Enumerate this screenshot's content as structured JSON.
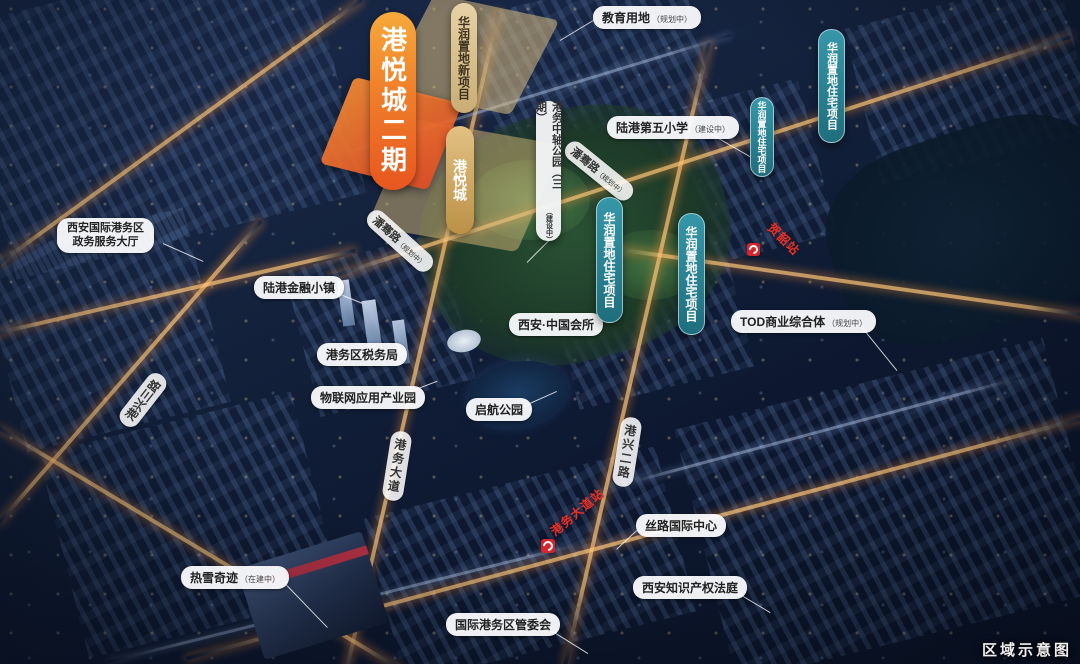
{
  "badges": {
    "main": "港悦城二期",
    "cr_new": "华润置地新项目",
    "gyc": "港悦城",
    "axis_park": {
      "text": "港务中轴公园（三期）",
      "status": "（建设中）"
    },
    "cr_res": "华润置地住宅项目"
  },
  "pois": {
    "education": {
      "text": "教育用地",
      "status": "（规划中）"
    },
    "school": {
      "text": "陆港第五小学",
      "status": "（建设中）"
    },
    "gov": {
      "line1": "西安国际港务区",
      "line2": "政务服务大厅"
    },
    "finance_town": "陆港金融小镇",
    "tax_bureau": "港务区税务局",
    "iot_park": "物联网应用产业园",
    "qihang_park": "启航公园",
    "china_club": "西安·中国会所",
    "tod": {
      "text": "TOD商业综合体",
      "status": "（规划中）"
    },
    "silk_center": "丝路国际中心",
    "ip_court": "西安知识产权法庭",
    "admin_committee": "国际港务区管委会",
    "snow_world": {
      "text": "热雪奇迹",
      "status": "（在建中）"
    }
  },
  "roads": {
    "gangxing3": "港兴三路",
    "gangwu_ave": "港务大道",
    "gangxing2": "港兴二路",
    "panqian": {
      "text": "潘骞路",
      "status": "（规划中）"
    }
  },
  "metro": {
    "heshao": "贺韶站",
    "gangwu_station": "港务大道站"
  },
  "footer": "区域示意图",
  "colors": {
    "main_badge_orange": "#e8561f",
    "cr_teal": "#2f8d9e",
    "parcel_tan": "#d8bc80",
    "metro_red": "#d6252b",
    "night_base": "#0d1830"
  }
}
